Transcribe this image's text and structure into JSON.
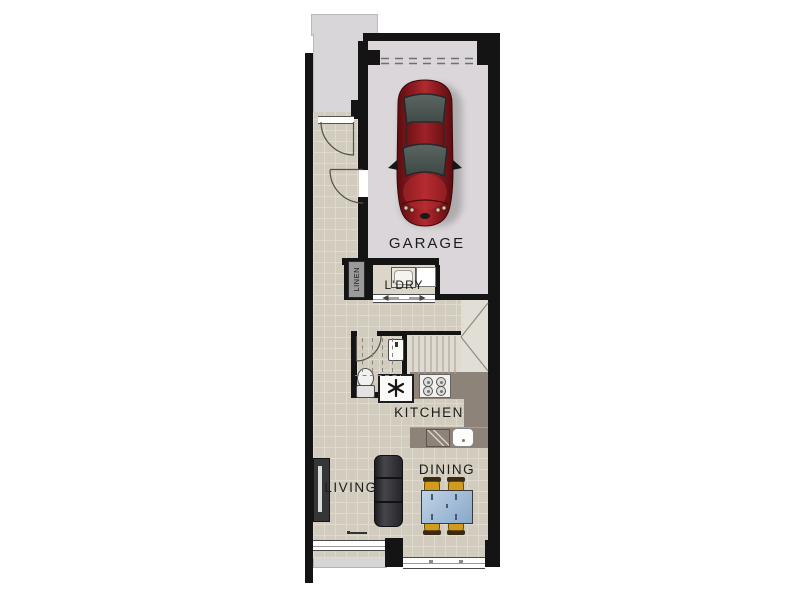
{
  "labels": {
    "garage": "GARAGE",
    "laundry": "L'DRY",
    "linen": "LINEN",
    "kitchen": "KITCHEN",
    "living": "LIVING",
    "dining": "DINING"
  },
  "fixtures": {
    "garage": [
      "car",
      "garage-door-dashed",
      "entry-door-arc",
      "garage-access-door-arc"
    ],
    "laundry": [
      "laundry-tub",
      "washing-machine",
      "sliding-door"
    ],
    "wc": [
      "toilet",
      "basin",
      "wc-door-arc",
      "understair-dashed-lines"
    ],
    "stairs": [
      "treads",
      "winder-diagonals"
    ],
    "kitchen": [
      "cooktop-4-burner",
      "sink",
      "dishwasher",
      "asterisk-appliance-marker",
      "benchtops"
    ],
    "living": [
      "sofa",
      "tv-unit",
      "window",
      "patio-slab"
    ],
    "dining": [
      "dining-table",
      "chairs-x4",
      "rear-sliding-door"
    ]
  },
  "colors": {
    "wall": "#141414",
    "tile": "#d2ccbe",
    "grout": "#dfdacd",
    "garage_floor": "#dad6d9",
    "porch": "#d9d6d9",
    "patio": "#d7d4d7",
    "ldry_floor": "#dcd6c8",
    "linen_bg": "#9a9a9a",
    "stair_floor": "#dfdbd0",
    "winder_floor": "#e1ded6",
    "bench": "#8d8378",
    "table_blue": "#c0d3e6",
    "chair_gold": "#d29b1c",
    "car_red": "#8f1b20"
  }
}
